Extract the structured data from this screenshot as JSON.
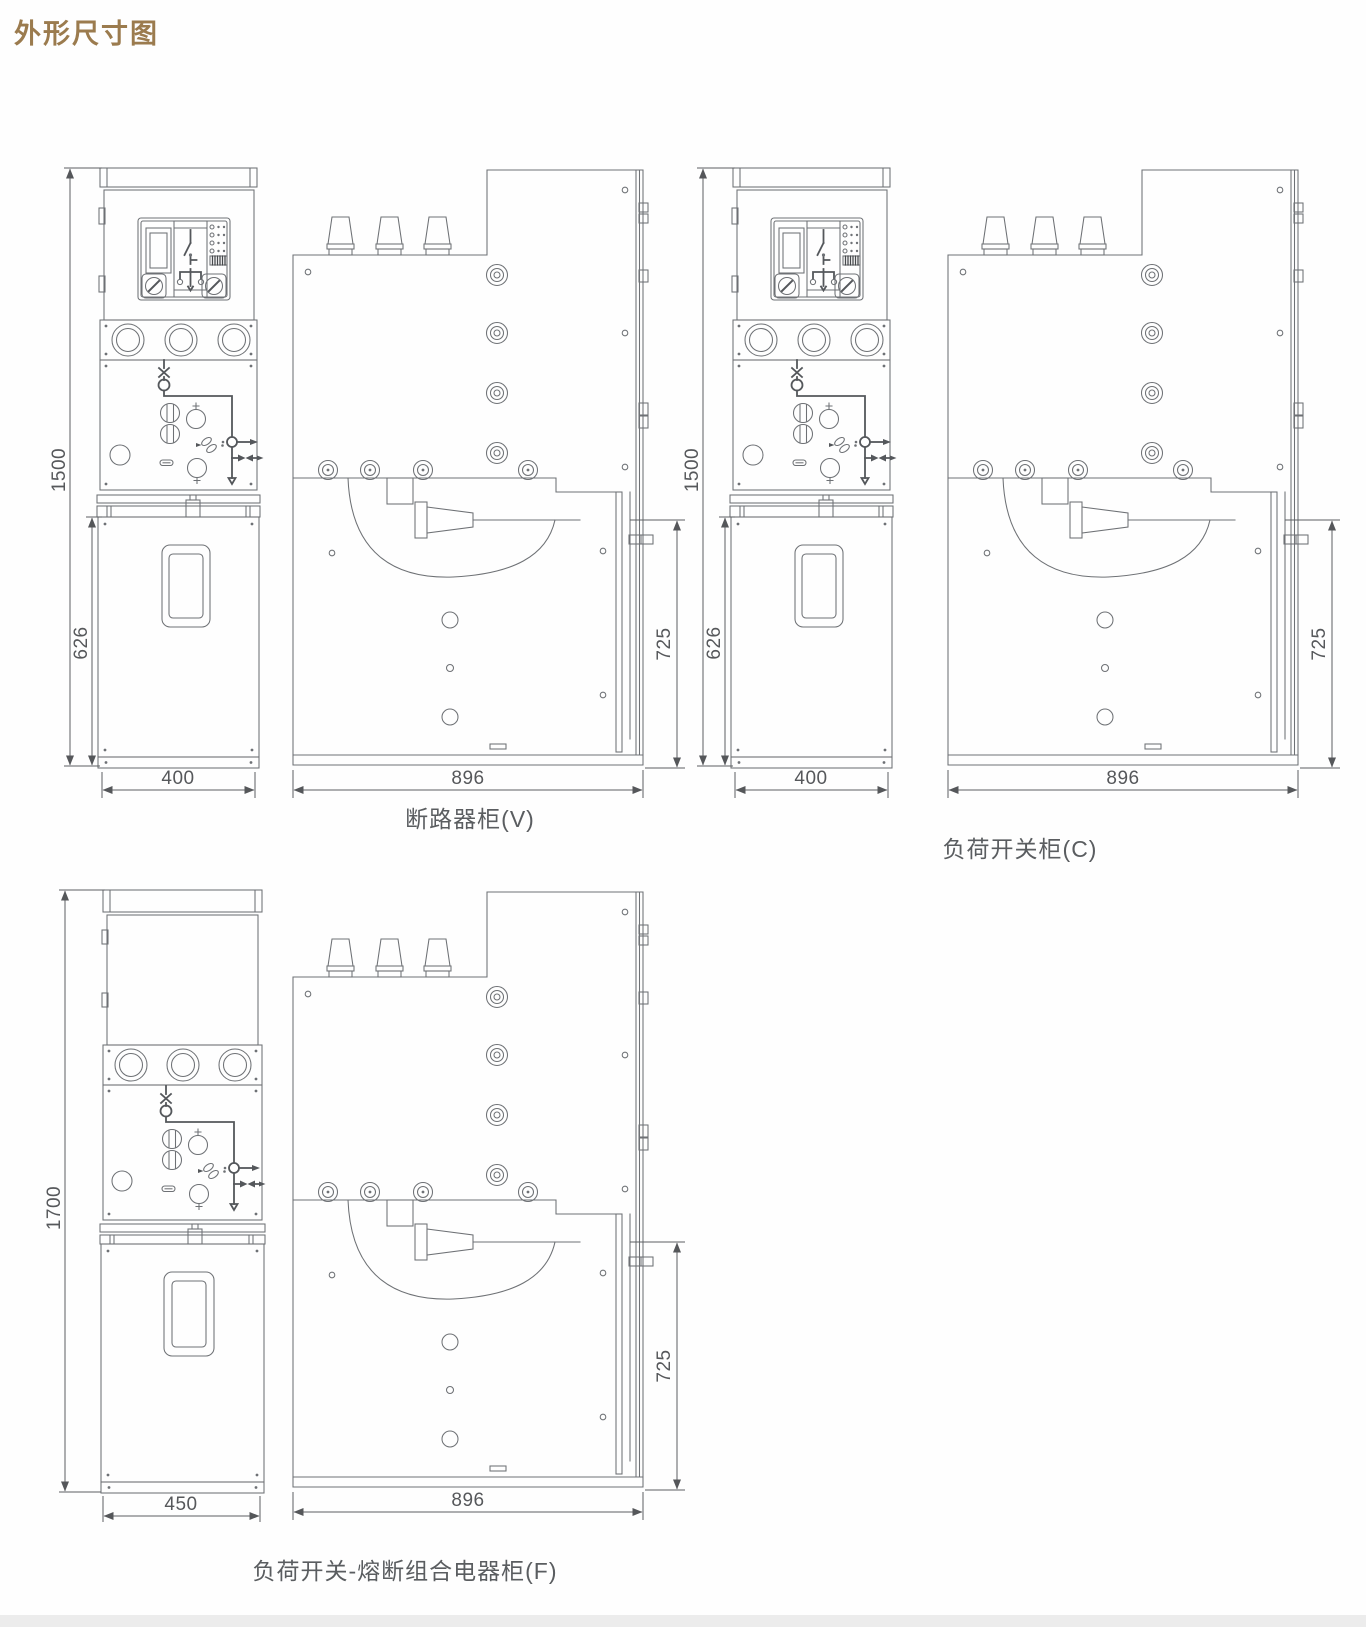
{
  "page": {
    "title": "外形尺寸图",
    "accent_color": "#9b7b4e",
    "line_color": "#6e7175",
    "text_color": "#5a5d60"
  },
  "figures": [
    {
      "id": "V",
      "caption": "断路器柜(V)",
      "dims": {
        "height_total": "1500",
        "lower_height": "626",
        "front_width": "400",
        "depth": "896",
        "lower_depth": "725"
      }
    },
    {
      "id": "C",
      "caption": "负荷开关柜(C)",
      "dims": {
        "height_total": "1500",
        "lower_height": "626",
        "front_width": "400",
        "depth": "896",
        "lower_depth": "725"
      }
    },
    {
      "id": "F",
      "caption": "负荷开关-熔断组合电器柜(F)",
      "dims": {
        "height_total": "1700",
        "front_width": "450",
        "depth": "896",
        "lower_depth": "725"
      }
    }
  ]
}
